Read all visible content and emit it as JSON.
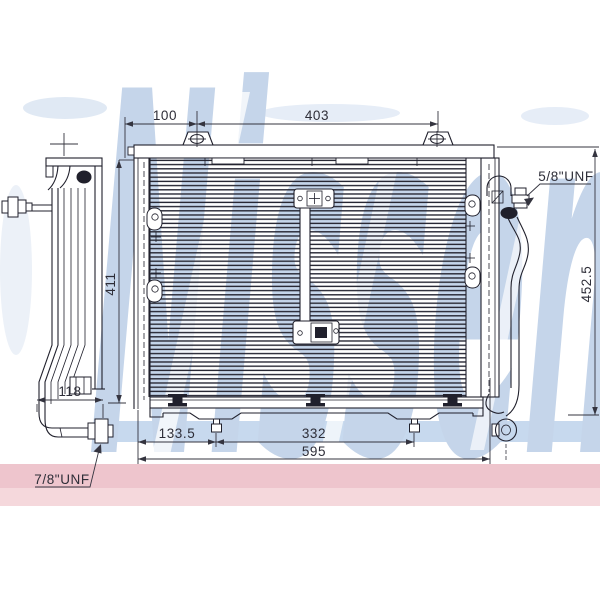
{
  "watermark": {
    "brand_text": "Nissens",
    "letter_color": "#c5d5ea",
    "blue_band_color": "#c7d9ee",
    "pink_band_color": "#eec5cd",
    "pink_band_light": "#f5d8dc"
  },
  "drawing": {
    "line_color": "#20202c",
    "dimension_color": "#34343f",
    "dimensions": {
      "top_offset": "100",
      "mount_hole_spacing": "403",
      "core_height": "411",
      "overall_height": "452.5",
      "pipe_offset": "118",
      "bottom_pin_offset": "133.5",
      "bottom_pin_spacing": "332",
      "overall_width": "595"
    },
    "fittings": {
      "right_thread": "5/8\"UNF",
      "left_thread": "7/8\"UNF"
    }
  }
}
